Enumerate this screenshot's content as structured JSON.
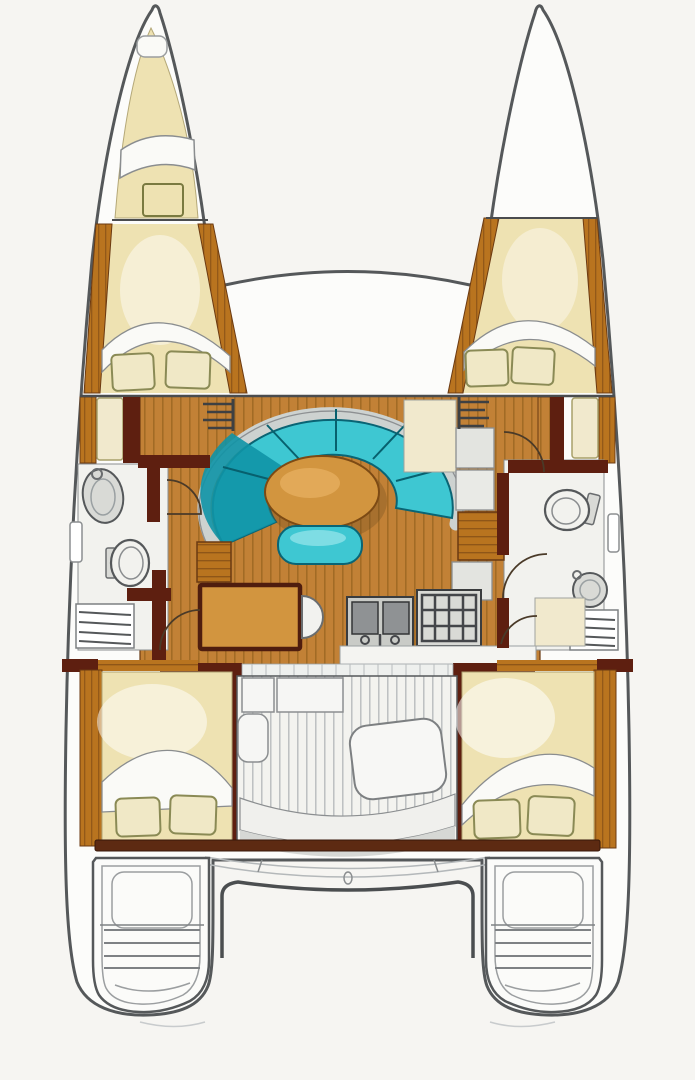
{
  "page": {
    "title": "Catamaran interior floor plan (top view)",
    "description": "Hand-drawn top-down layout of a 4-cabin sailing catamaran"
  },
  "colors": {
    "background": "#f6f5f2",
    "hullFill": "#fcfcfa",
    "outline": "#55585a",
    "woodFloor": "#c28136",
    "woodPlankLine": "#a06a24",
    "woodTrim": "#b9741f",
    "woodTrimLine": "#8f5618",
    "woodEdge": "#6b3a12",
    "wallDark": "#5e1f10",
    "beamBrown": "#5d2a12",
    "bedCream": "#eee2b2",
    "blanketWhite": "#fafaf7",
    "pillowCream": "#f0e8c6",
    "pillowOutline": "#8a8a55",
    "creamLight": "#f1e9cd",
    "sofaTeal": "#3ec7d2",
    "sofaTealDark": "#0f93a6",
    "sofaDivider": "#07606e",
    "backrestGray": "#cdd2d0",
    "tableWood": "#d2953f",
    "tableEdge": "#7c4a14",
    "fixtureGray": "#d9dad6",
    "fixtureOutline": "#55585a",
    "applianceDark": "#8f9294",
    "deckFill": "#f3f3ef",
    "deckStripe": "#b4b8ba",
    "whiteRoom": "#f2f2ee"
  },
  "rooms": [
    {
      "id": "port-bow-berth",
      "label": "Port bow single berth"
    },
    {
      "id": "port-forward-cabin",
      "label": "Port forward double cabin"
    },
    {
      "id": "starboard-forward-cabin",
      "label": "Starboard forward double cabin"
    },
    {
      "id": "port-head",
      "label": "Port head with sink and toilet"
    },
    {
      "id": "starboard-head",
      "label": "Starboard head with toilet and sink"
    },
    {
      "id": "salon",
      "label": "Salon with curved settee and oval table"
    },
    {
      "id": "galley",
      "label": "Galley with double sink and stove"
    },
    {
      "id": "nav-desk",
      "label": "Chart table with stool"
    },
    {
      "id": "cockpit",
      "label": "Aft cockpit with seats and bench"
    },
    {
      "id": "port-aft-cabin",
      "label": "Port aft double cabin"
    },
    {
      "id": "starboard-aft-cabin",
      "label": "Starboard aft double cabin"
    },
    {
      "id": "port-transom",
      "label": "Port transom swim steps"
    },
    {
      "id": "starboard-transom",
      "label": "Starboard transom swim steps"
    },
    {
      "id": "trampoline",
      "label": "Foredeck between bows"
    },
    {
      "id": "aft-platform",
      "label": "Aft beam and davit arch"
    }
  ]
}
